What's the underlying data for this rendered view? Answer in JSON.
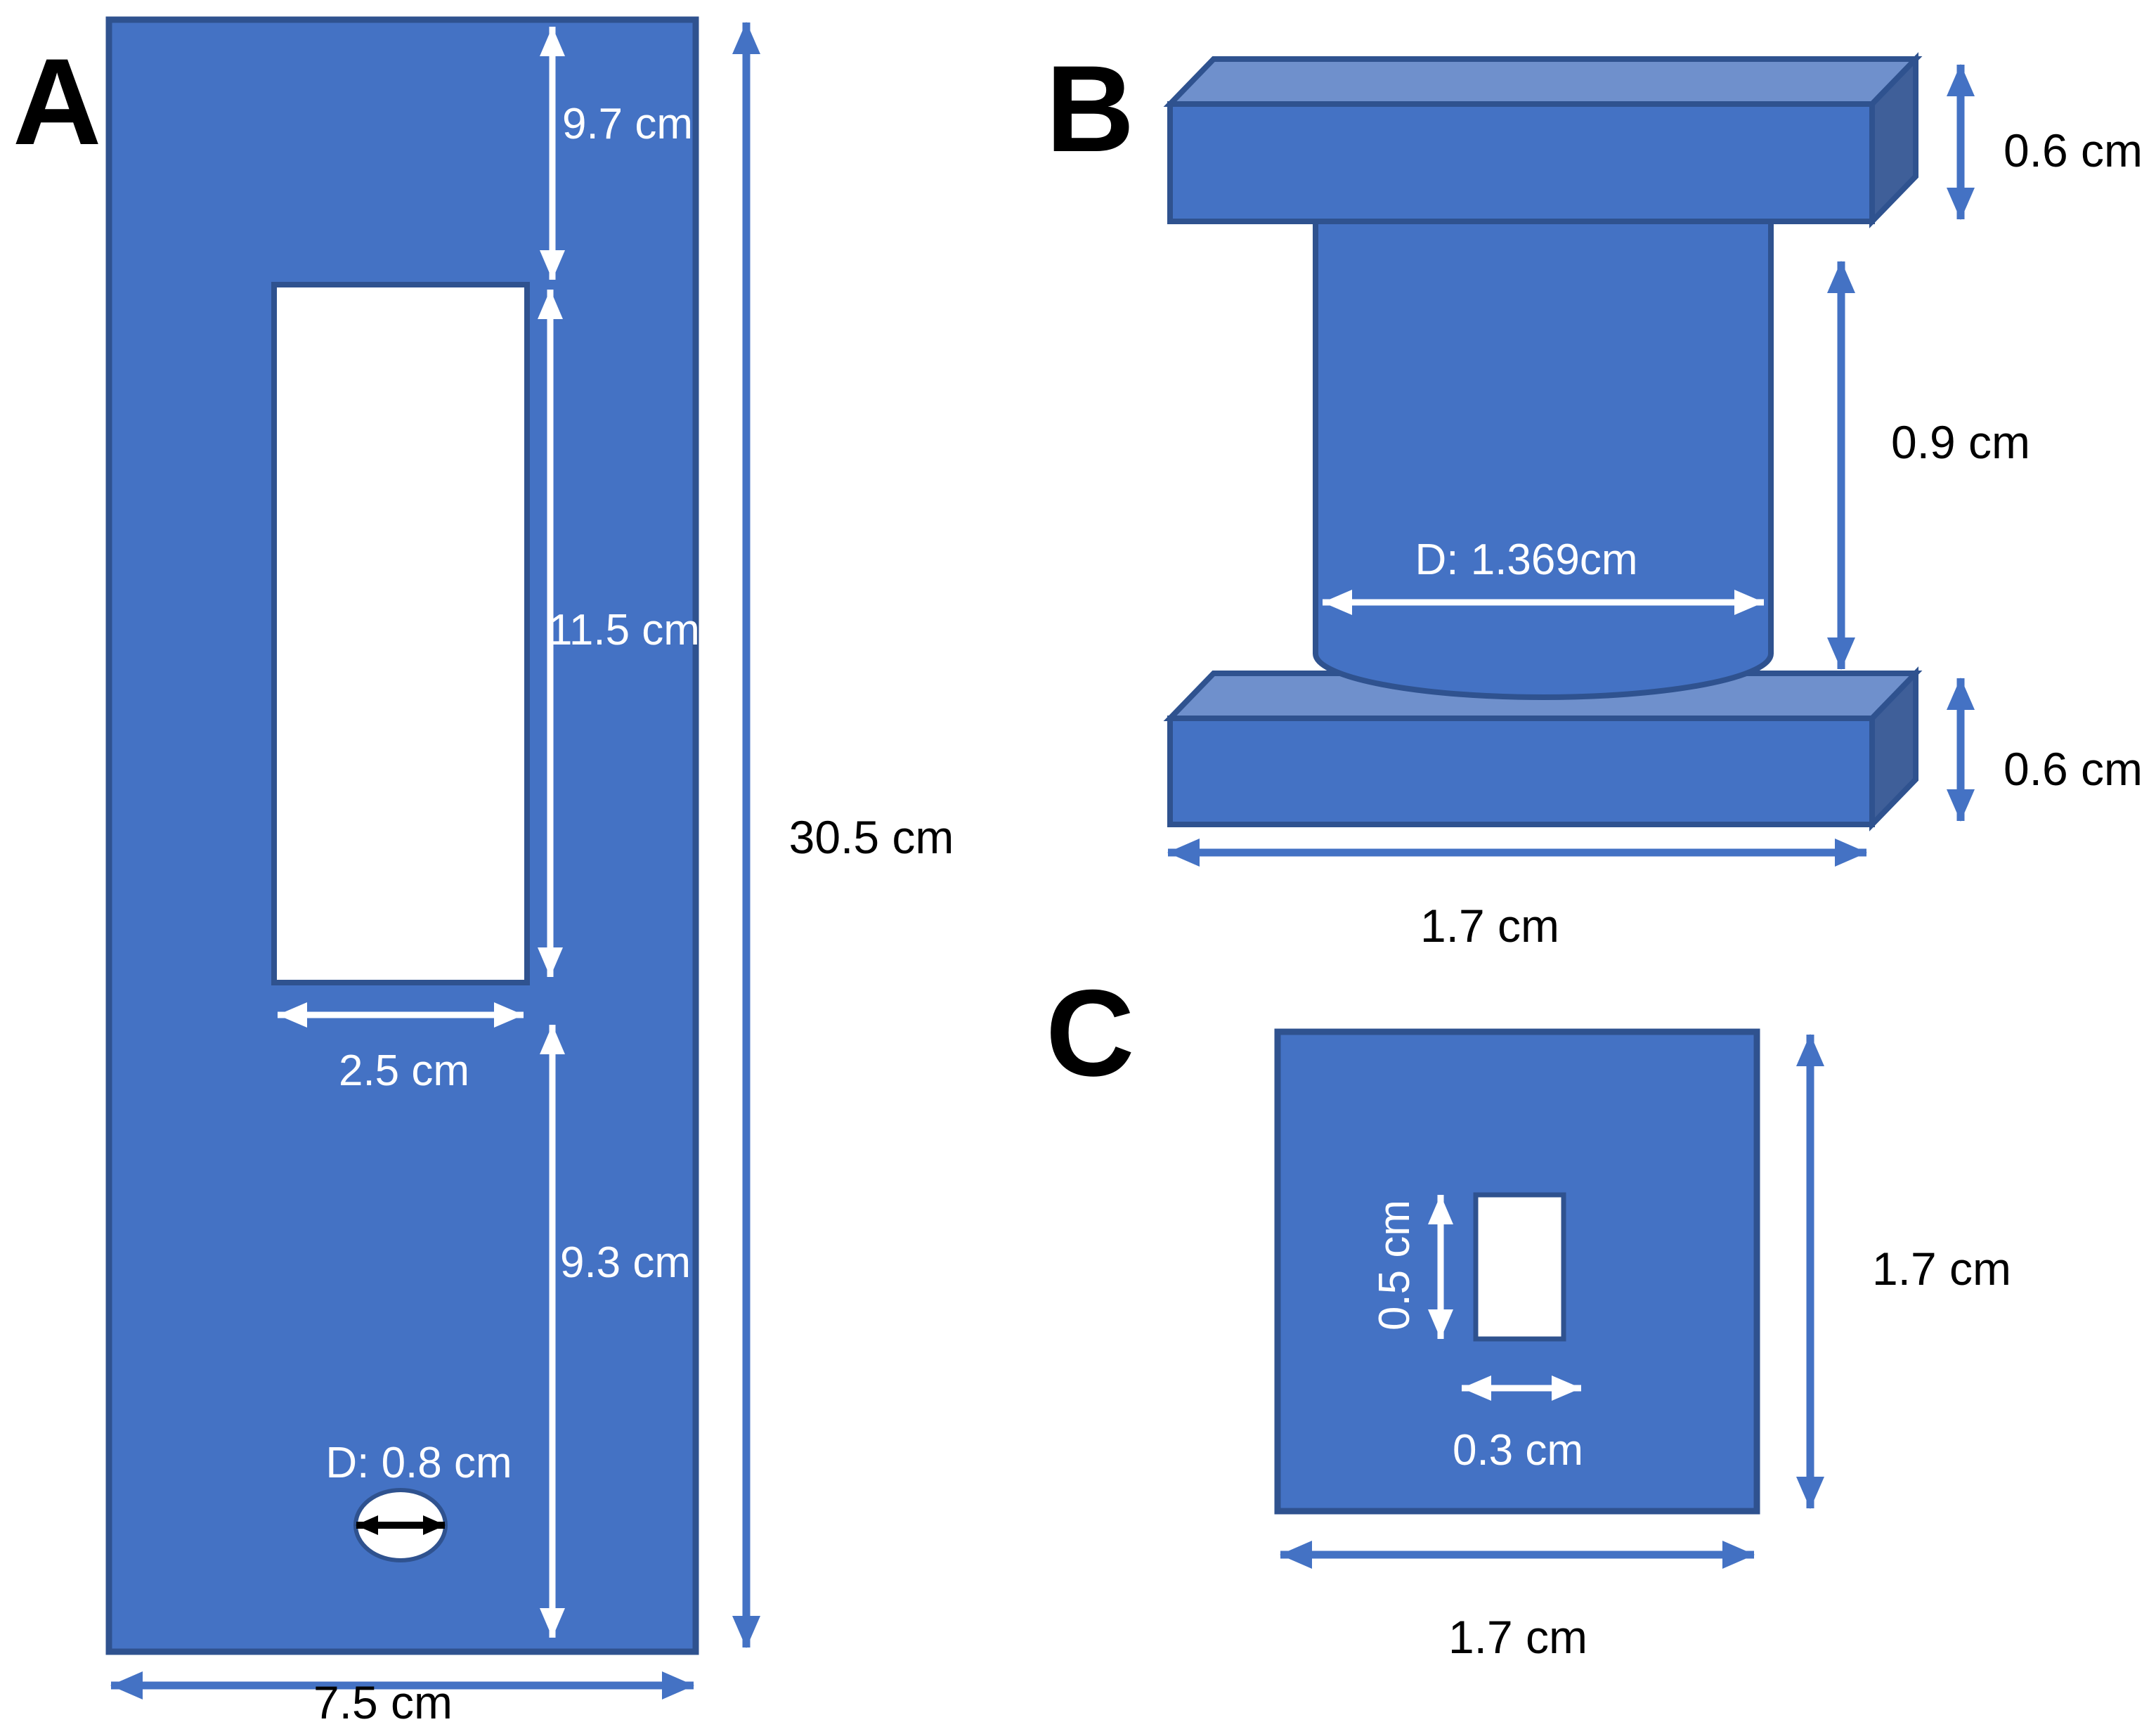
{
  "panel_a": {
    "label": "A",
    "dim_top_gap": "9.7 cm",
    "dim_slot_height": "11.5 cm",
    "dim_slot_width": "2.5 cm",
    "dim_below_slot": "9.3 cm",
    "dim_hole_diameter": "D: 0.8 cm",
    "dim_total_height": "30.5 cm",
    "dim_total_width": "7.5 cm"
  },
  "panel_b": {
    "label": "B",
    "dim_top_flange_thickness": "0.6 cm",
    "dim_cylinder_height": "0.9 cm",
    "dim_cylinder_diameter": "D: 1.369cm",
    "dim_bottom_flange_thickness": "0.6 cm",
    "dim_flange_width": "1.7 cm"
  },
  "panel_c": {
    "label": "C",
    "dim_cutout_height": "0.5 cm",
    "dim_cutout_width": "0.3 cm",
    "dim_plate_height": "1.7 cm",
    "dim_plate_width": "1.7 cm"
  },
  "colors": {
    "shape_fill": "#4472C4",
    "shape_top": "#6F90CC",
    "shape_side": "#3F5F99",
    "outline": "#2F528F",
    "dimension_arrow": "#4472C4",
    "text_light": "#FFFFFF",
    "text_dark": "#000000"
  }
}
